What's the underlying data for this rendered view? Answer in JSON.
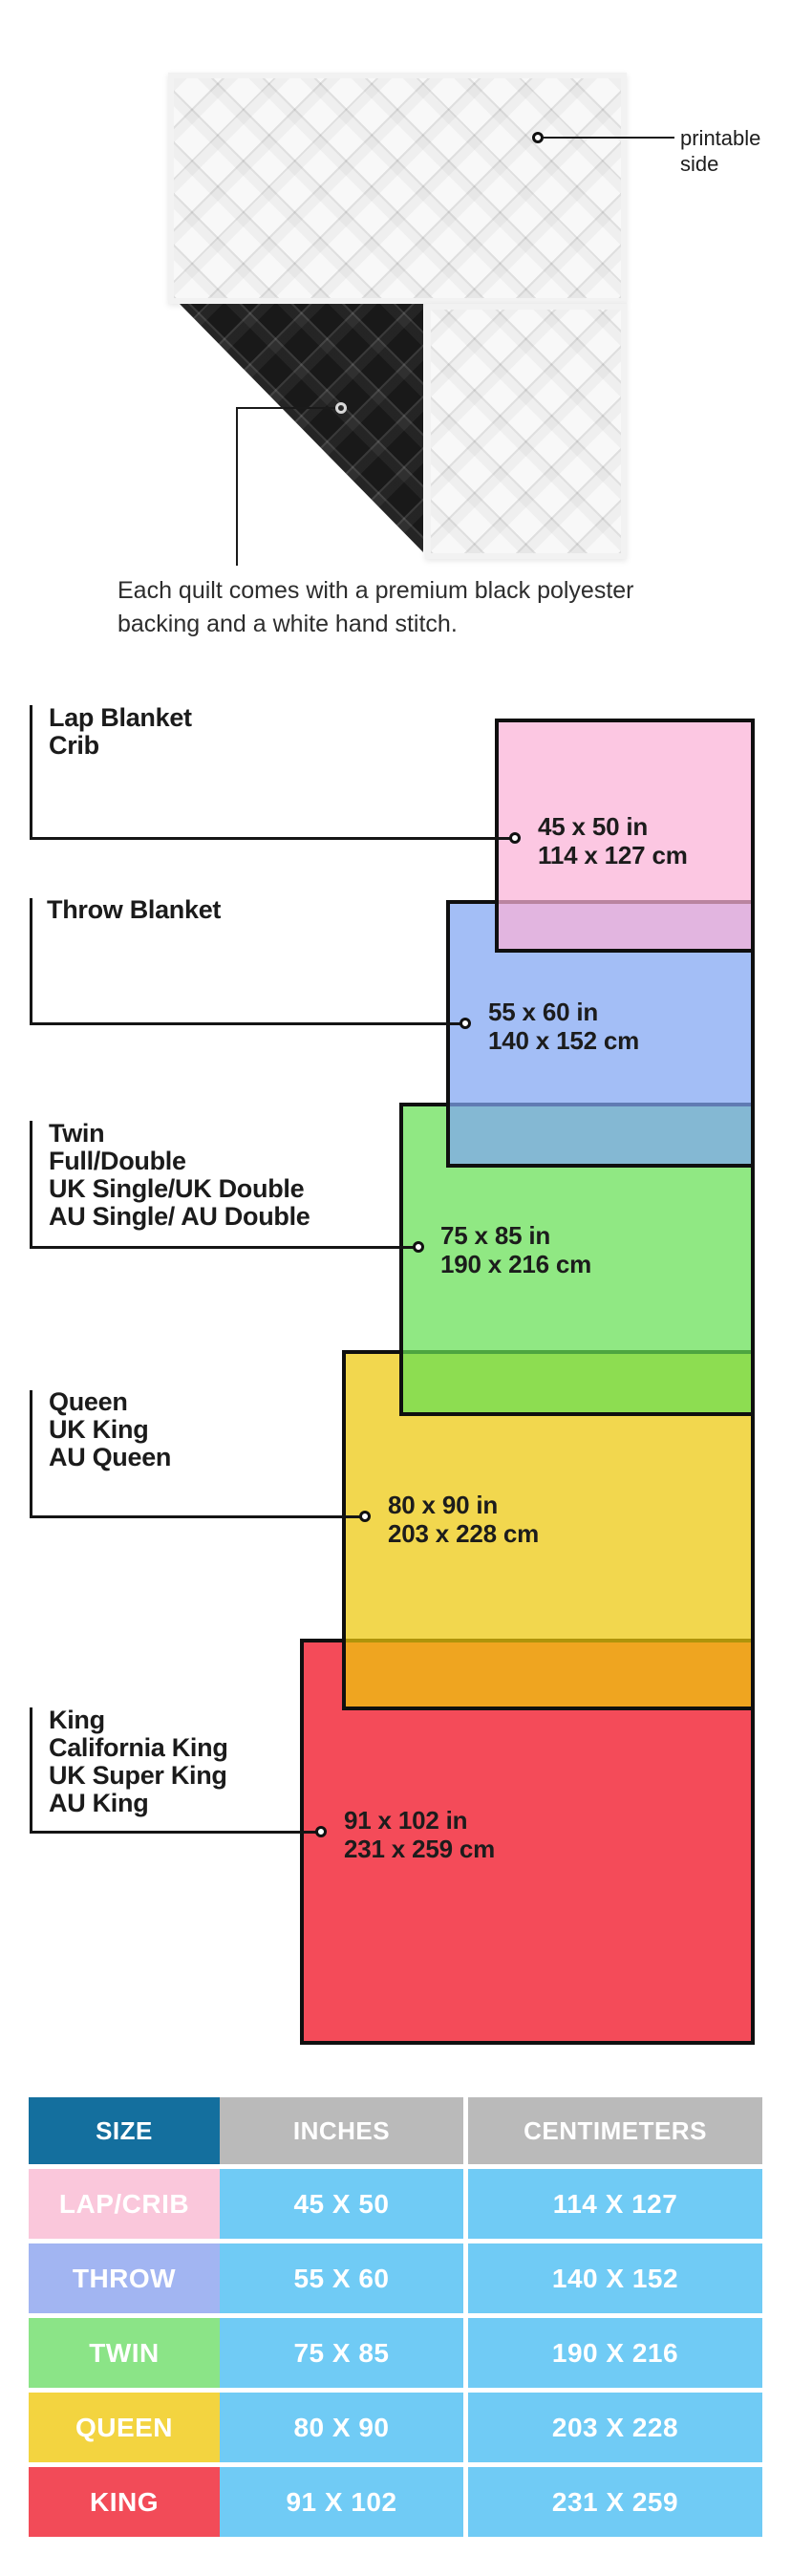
{
  "quilt": {
    "printable_label_lines": [
      "printable",
      "side"
    ],
    "caption_lines": [
      "Each quilt comes with a premium black polyester",
      "backing and a white hand stitch."
    ],
    "front_color": "#f8f8f8",
    "backing_color": "#191919"
  },
  "diagram": {
    "line_color": "#151515",
    "sizes": [
      {
        "id": "lap-crib",
        "label_lines": [
          "Lap Blanket",
          "Crib"
        ],
        "inches": "45 x 50 in",
        "centimeters": "114 x 127 cm",
        "fill": "rgba(251,177,215,0.72)"
      },
      {
        "id": "throw",
        "label_lines": [
          "Throw Blanket"
        ],
        "inches": "55 x 60 in",
        "centimeters": "140 x 152 cm",
        "fill": "rgba(127,165,243,0.72)"
      },
      {
        "id": "twin",
        "label_lines": [
          "Twin",
          "Full/Double",
          "UK Single/UK Double",
          "AU Single/ AU Double"
        ],
        "inches": "75 x 85 in",
        "centimeters": "190 x 216 cm",
        "fill": "rgba(101,223,83,0.72)"
      },
      {
        "id": "queen",
        "label_lines": [
          "Queen",
          "UK King",
          "AU Queen"
        ],
        "inches": "80 x 90 in",
        "centimeters": "203 x 228 cm",
        "fill": "rgba(237,199,10,0.72)"
      },
      {
        "id": "king",
        "label_lines": [
          "King",
          "California King",
          "UK Super King",
          "AU King"
        ],
        "inches": "91 x 102 in",
        "centimeters": "231 x 259 cm",
        "fill": "rgba(240,5,25,0.72)"
      }
    ]
  },
  "table": {
    "headers": [
      "SIZE",
      "INCHES",
      "CENTIMETERS"
    ],
    "header_size_bg": "#146f9e",
    "header_gray_bg": "#bababa",
    "cell_bg": "#70cbf5",
    "text_color": "#ffffff",
    "rows": [
      {
        "size": "LAP/CRIB",
        "inches": "45 X 50",
        "centimeters": "114 X 127",
        "swatch": "#fac7db"
      },
      {
        "size": "THROW",
        "inches": "55 X 60",
        "centimeters": "140 X 152",
        "swatch": "#a2b5f2"
      },
      {
        "size": "TWIN",
        "inches": "75 X 85",
        "centimeters": "190 X 216",
        "swatch": "#8be487"
      },
      {
        "size": "QUEEN",
        "inches": "80 X 90",
        "centimeters": "203 X 228",
        "swatch": "#f3d440"
      },
      {
        "size": "KING",
        "inches": "91 X 102",
        "centimeters": "231 X 259",
        "swatch": "#f24b58"
      }
    ]
  }
}
